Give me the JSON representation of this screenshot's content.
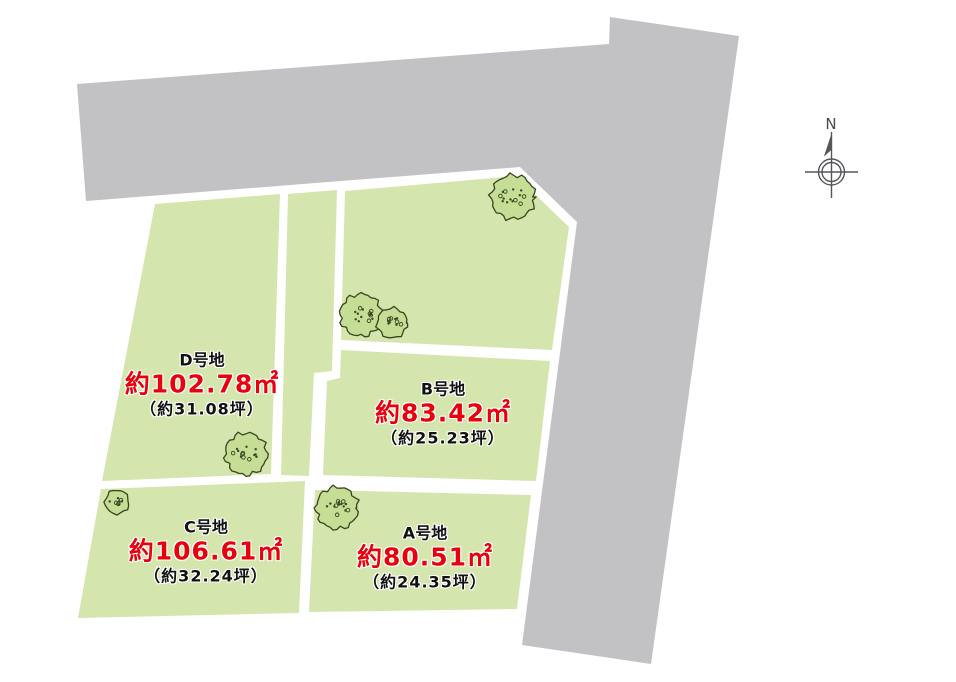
{
  "site_plan": {
    "colors": {
      "road": "#c2c2c4",
      "lot": "#d5e5ae",
      "tree_fill": "#c6dd96",
      "tree_stroke": "#39451f",
      "area_text": "#e8000d",
      "label_text": "#111111"
    },
    "compass": {
      "label": "N"
    },
    "lots": [
      {
        "id": "A",
        "name": "A号地",
        "area": "約80.51㎡",
        "tsubo": "（約24.35坪）"
      },
      {
        "id": "B",
        "name": "B号地",
        "area": "約83.42㎡",
        "tsubo": "（約25.23坪）"
      },
      {
        "id": "C",
        "name": "C号地",
        "area": "約106.61㎡",
        "tsubo": "（約32.24坪）"
      },
      {
        "id": "D",
        "name": "D号地",
        "area": "約102.78㎡",
        "tsubo": "（約31.08坪）"
      }
    ],
    "trees": [
      {
        "cx": 513,
        "cy": 197,
        "r": 22
      },
      {
        "cx": 361,
        "cy": 315,
        "r": 21
      },
      {
        "cx": 392,
        "cy": 323,
        "r": 15
      },
      {
        "cx": 246,
        "cy": 454,
        "r": 21
      },
      {
        "cx": 117,
        "cy": 502,
        "r": 12
      },
      {
        "cx": 337,
        "cy": 508,
        "r": 21
      }
    ]
  }
}
